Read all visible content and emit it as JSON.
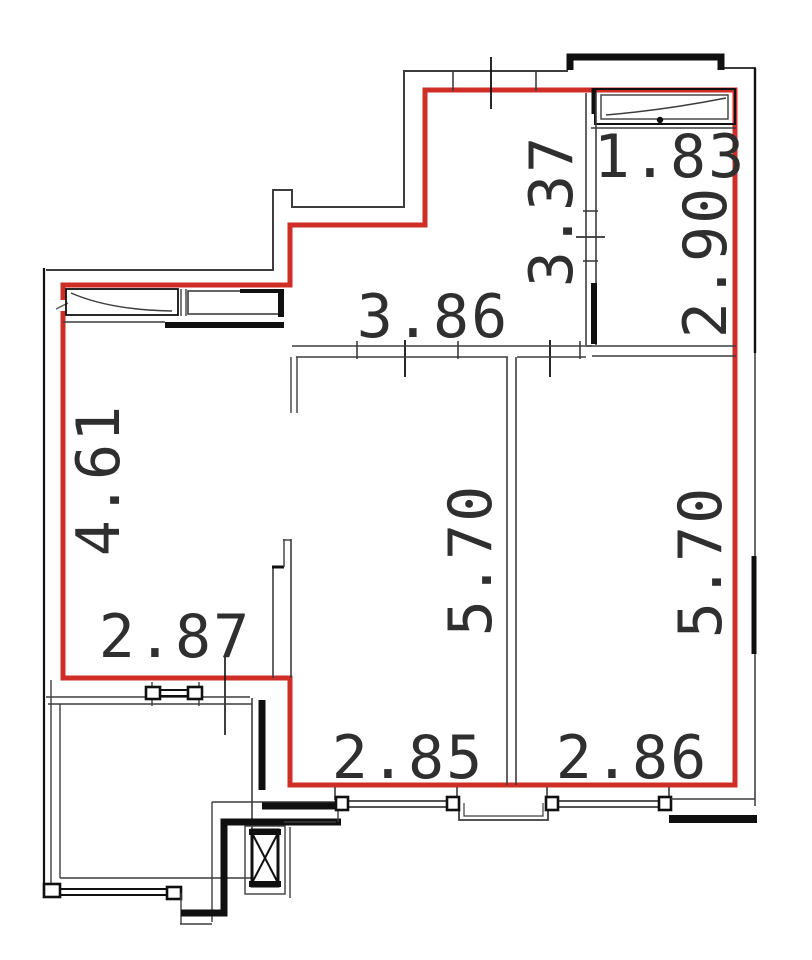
{
  "drawing": {
    "type": "apartment floor plan",
    "unit": "m",
    "description": "Floor plan with red apartment boundary, two rooms 5.70 deep, hall, corner room 1.83 x 2.90, balcony and elevator shaft"
  },
  "colors": {
    "background": "#ffffff",
    "boundary_red": "#cf2e27",
    "wall_gray": "#3d3d3d",
    "wall_mid": "#5a5a5a",
    "wall_dark": "#101010",
    "label": "#2f2f2f"
  },
  "labels": [
    {
      "value": "1.83",
      "orientation": "horizontal",
      "x": 670,
      "y": 157
    },
    {
      "value": "2.90",
      "orientation": "vertical",
      "x": 706,
      "y": 262
    },
    {
      "value": "3.37",
      "orientation": "vertical",
      "x": 552,
      "y": 211
    },
    {
      "value": "3.86",
      "orientation": "horizontal",
      "x": 433,
      "y": 317
    },
    {
      "value": "4.61",
      "orientation": "vertical",
      "x": 99,
      "y": 480
    },
    {
      "value": "2.87",
      "orientation": "horizontal",
      "x": 175,
      "y": 637
    },
    {
      "value": "5.70",
      "orientation": "vertical",
      "x": 471,
      "y": 560
    },
    {
      "value": "5.70",
      "orientation": "vertical",
      "x": 701,
      "y": 562
    },
    {
      "value": "2.85",
      "orientation": "horizontal",
      "x": 408,
      "y": 758
    },
    {
      "value": "2.86",
      "orientation": "horizontal",
      "x": 632,
      "y": 758
    }
  ]
}
